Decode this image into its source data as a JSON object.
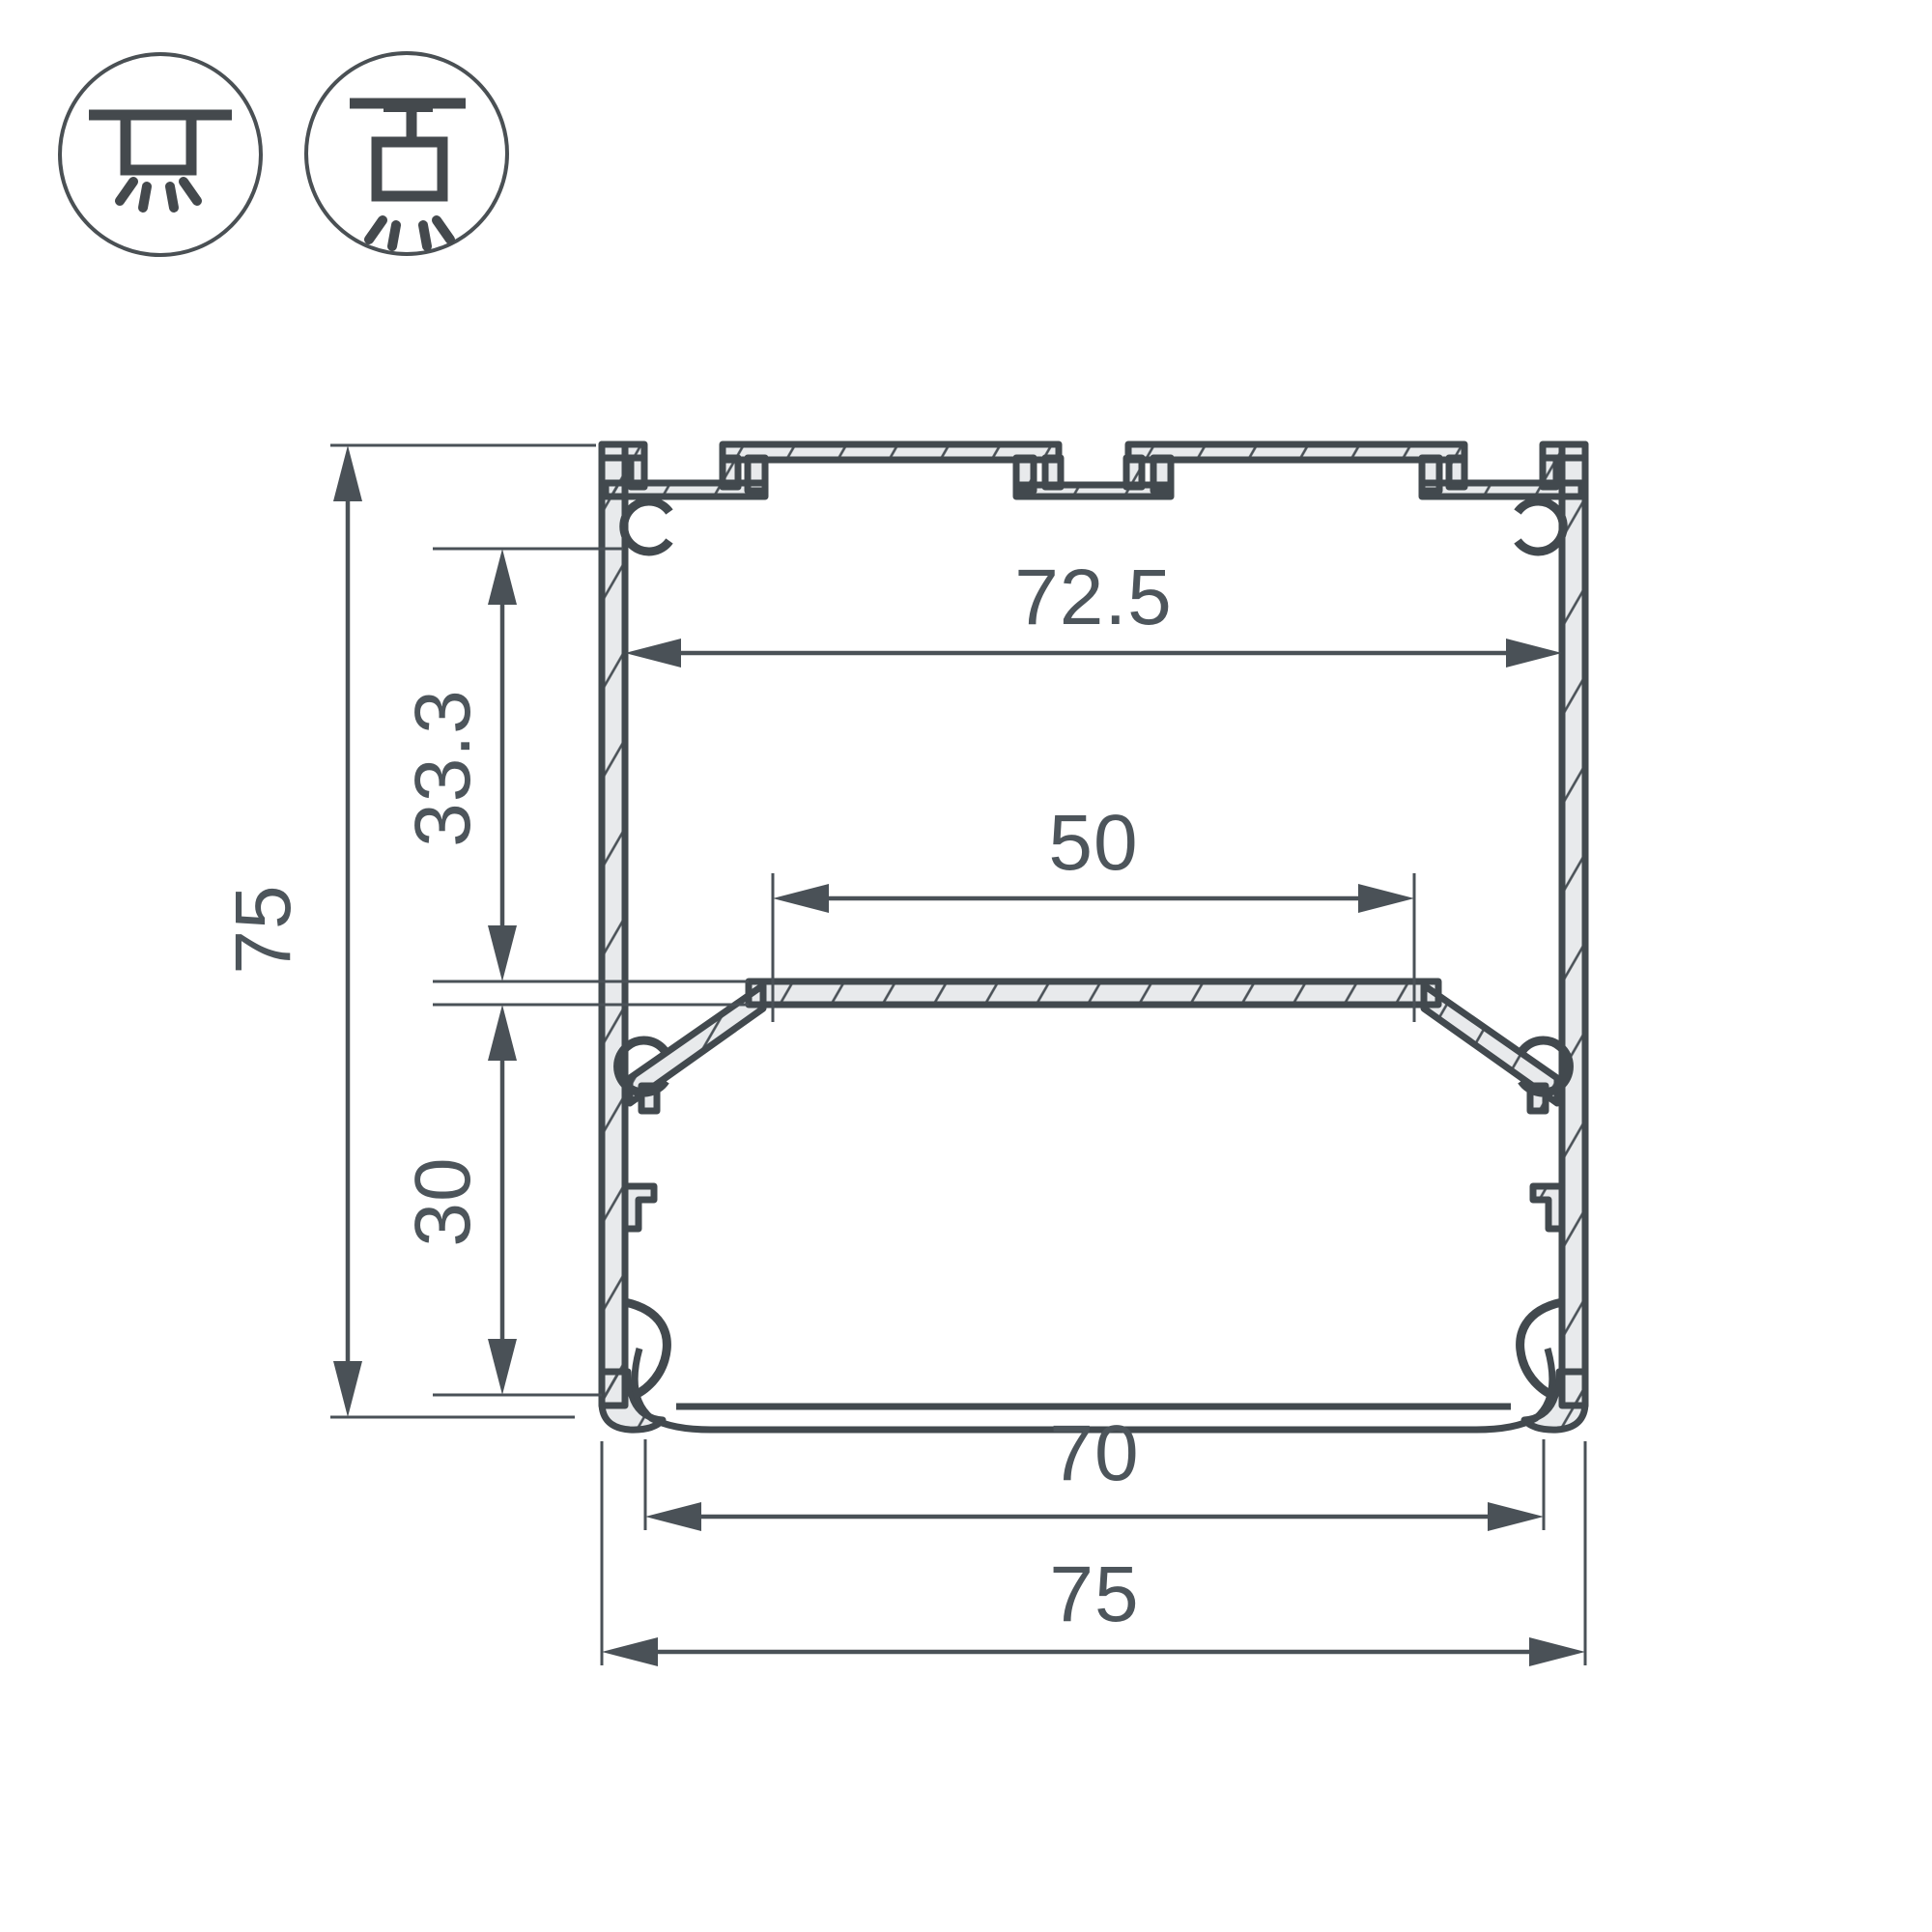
{
  "title": "led-profile-cross-section-drawing",
  "mounting_icons": {
    "icon1": "surface-ceiling-mount",
    "icon2": "pendant-suspension-mount"
  },
  "dimensions": {
    "overall_height": "75",
    "upper_inner_height": "33.3",
    "lower_inner_height": "30",
    "top_inner_width": "72.5",
    "led_platform_width": "50",
    "bottom_opening_width": "70",
    "overall_width": "75"
  },
  "colors": {
    "background": "#ffffff",
    "profile_outline": "#42494e",
    "profile_fill": "#e8eaec",
    "dimension_lines": "#4a5157",
    "text": "#4d555b"
  }
}
